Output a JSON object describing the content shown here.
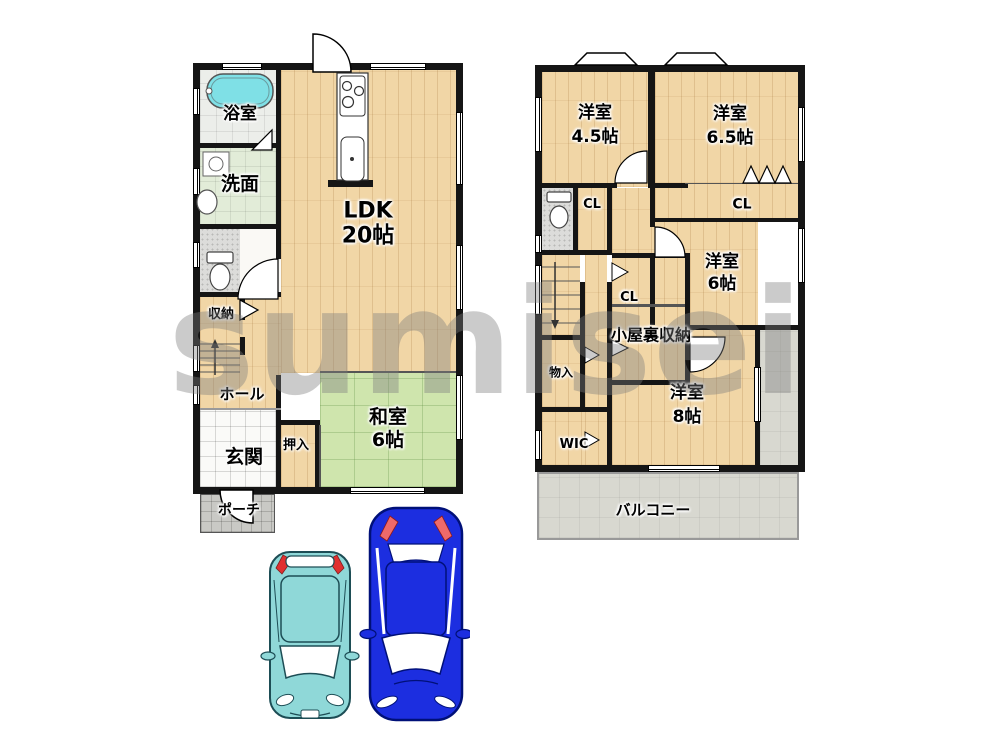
{
  "watermark": "sumisei",
  "floor1": {
    "bath": "浴室",
    "washroom": "洗面",
    "storage": "収納",
    "hall": "ホール",
    "entrance": "玄関",
    "closet": "押入",
    "porch": "ポーチ",
    "ldk_name": "LDK",
    "ldk_size": "20帖",
    "tatami_name": "和室",
    "tatami_size": "6帖"
  },
  "floor2": {
    "room45_name": "洋室",
    "room45_size": "4.5帖",
    "room65_name": "洋室",
    "room65_size": "6.5帖",
    "room6_name": "洋室",
    "room6_size": "6帖",
    "room8_name": "洋室",
    "room8_size": "8帖",
    "closet_left": "CL",
    "closet_right": "CL",
    "closet_center": "CL",
    "attic": "小屋裏収納",
    "small_storage": "物入",
    "wic": "WIC",
    "balcony": "バルコニー"
  },
  "colors": {
    "wall": "#151515",
    "wood_floor": "#f1d6a6",
    "tatami": "#cfe5ad",
    "bathtub": "#7fe0e6",
    "balcony": "#d8d8d0",
    "car_compact": "#8fd8d8",
    "car_sedan": "#1c2ee0"
  }
}
